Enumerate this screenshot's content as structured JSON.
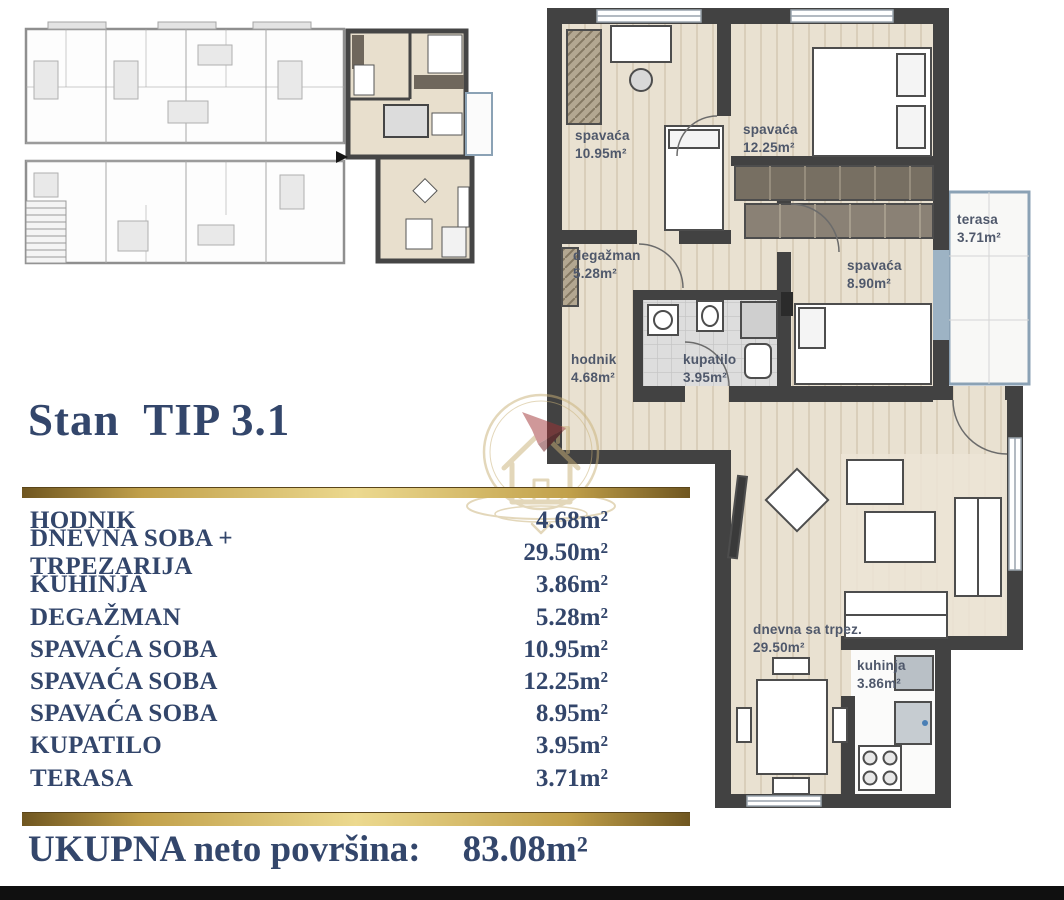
{
  "title": "Stan  TIP 3.1",
  "summary": {
    "rooms": [
      {
        "label": "HODNIK",
        "area": "4.68m²"
      },
      {
        "label": "DNEVNA SOBA + TRPEZARIJA",
        "area": "29.50m²"
      },
      {
        "label": "KUHINJA",
        "area": "3.86m²"
      },
      {
        "label": "DEGAŽMAN",
        "area": "5.28m²"
      },
      {
        "label": "SPAVAĆA SOBA",
        "area": "10.95m²"
      },
      {
        "label": "SPAVAĆA SOBA",
        "area": "12.25m²"
      },
      {
        "label": "SPAVAĆA SOBA",
        "area": "8.95m²"
      },
      {
        "label": "KUPATILO",
        "area": "3.95m²"
      },
      {
        "label": "TERASA",
        "area": "3.71m²"
      }
    ],
    "total_label": "UKUPNA neto površina:",
    "total_value": "83.08m²"
  },
  "plan": {
    "bedroom1": {
      "name": "spavaća",
      "area": "10.95m²"
    },
    "bedroom2": {
      "name": "spavaća",
      "area": "12.25m²"
    },
    "bedroom3": {
      "name": "spavaća",
      "area": "8.90m²"
    },
    "degazman": {
      "name": "degažman",
      "area": "5.28m²"
    },
    "hodnik": {
      "name": "hodnik",
      "area": "4.68m²"
    },
    "kupatilo": {
      "name": "kupatilo",
      "area": "3.95m²"
    },
    "terasa": {
      "name": "terasa",
      "area": "3.71m²"
    },
    "dnevna": {
      "name": "dnevna sa trpez.",
      "area": "29.50m²"
    },
    "kuhinja": {
      "name": "kuhinja",
      "area": "3.86m²"
    }
  },
  "colors": {
    "navy": "#33466b",
    "gold": "#c1a04a",
    "wall": "#424242",
    "floor": "#e9e1d1",
    "terrace_frame": "#8ba2b5",
    "bottom_bar": "#101010"
  }
}
